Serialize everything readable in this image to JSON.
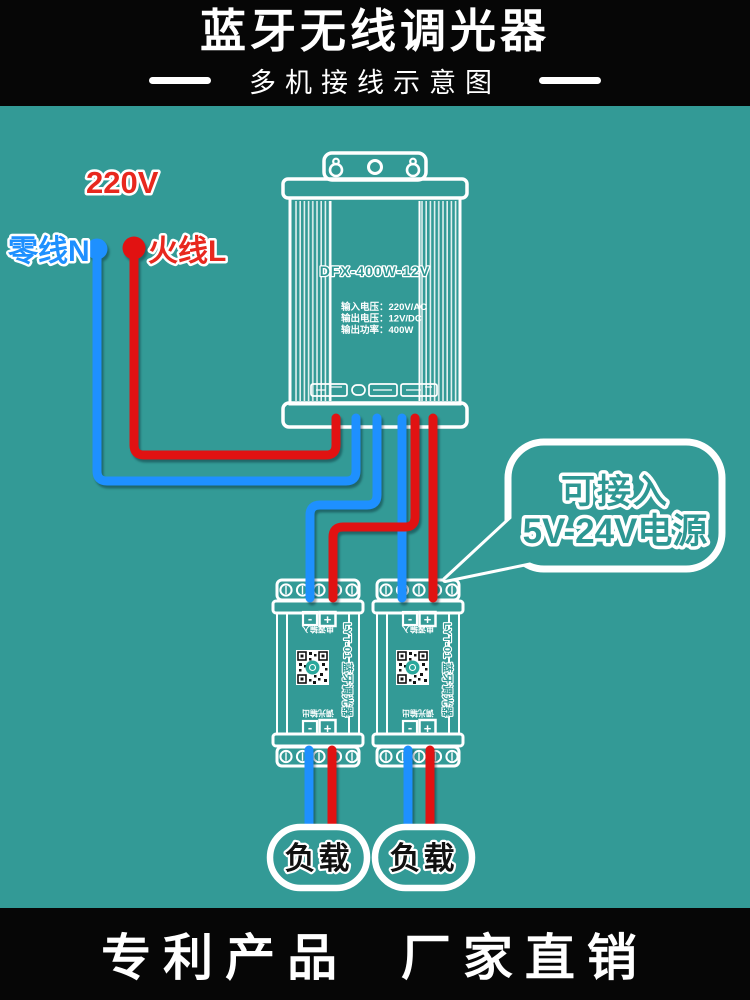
{
  "colors": {
    "background": "#339a96",
    "banner": "#060606",
    "wire_blue": "#1e90ff",
    "wire_red": "#e11212",
    "outline_white": "#ffffff",
    "label_red": "#e8281e",
    "label_blue": "#1e90ff"
  },
  "header": {
    "title": "蓝牙无线调光器",
    "subtitle": "多机接线示意图"
  },
  "input_labels": {
    "voltage": "220V",
    "neutral": "零线N",
    "live": "火线L"
  },
  "power_supply": {
    "model": "DFX-400W-12V",
    "spec_input": "输入电压：220V/AC",
    "spec_output": "输出电压：12V/DC",
    "spec_power": "输出功率：400W"
  },
  "bubble": {
    "line1": "可接入",
    "line2": "5V-24V电源"
  },
  "dimmer": {
    "model_label": "LYT-01 蓝牙调光器",
    "input_label": "电源输入",
    "output_label": "调光输出",
    "minus": "-",
    "plus": "+"
  },
  "load": {
    "label": "负载"
  },
  "footer": {
    "text": "专利产品  厂家直销"
  }
}
